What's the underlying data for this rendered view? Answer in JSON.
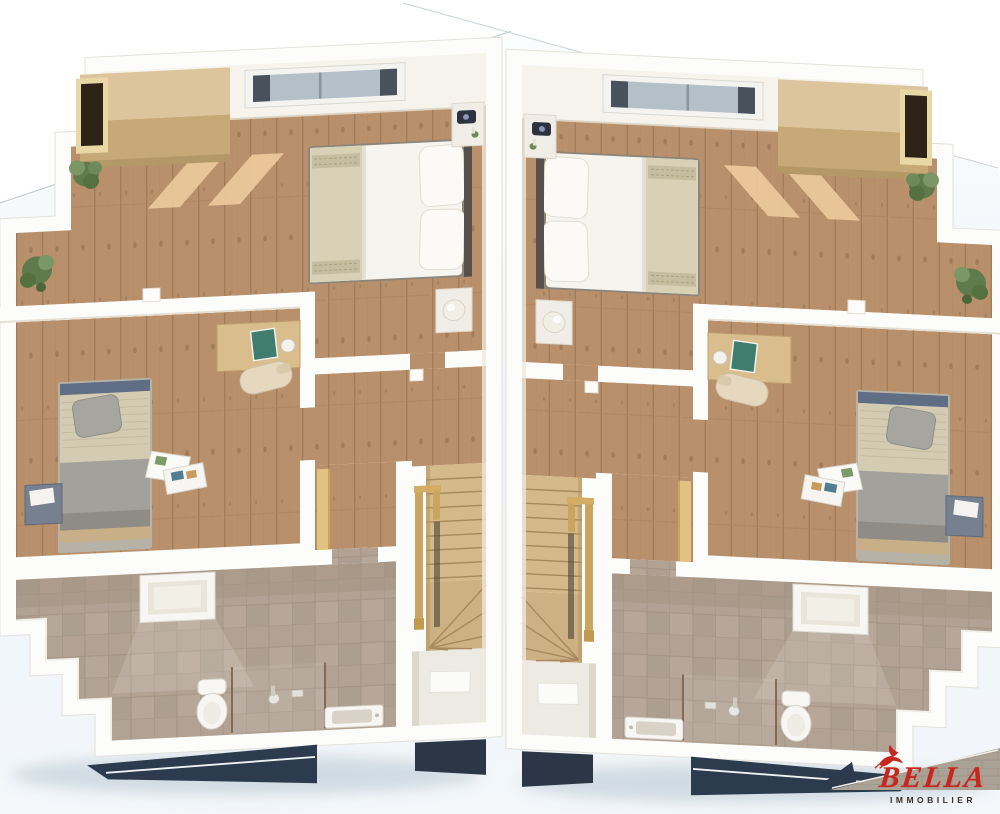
{
  "brand": {
    "name": "BELLA",
    "tagline": "IMMOBILIER",
    "icon": "bird-icon",
    "name_color": "#c5261e",
    "tagline_color": "#3a2f27"
  },
  "scene": {
    "type": "3d-floorplan-top-view",
    "description": "Two mirrored duplex upper floors shown side by side in 3D cutaway",
    "units": [
      {
        "name": "unit-left",
        "rooms": [
          {
            "name": "master-bedroom",
            "floor": "wood",
            "furniture": [
              "roof-window",
              "wardrobe",
              "double-bed",
              "nightstand-with-clock",
              "nightstand-with-lamp",
              "plant",
              "hanging-plant",
              "sunlight-patches"
            ]
          },
          {
            "name": "second-bedroom",
            "floor": "wood",
            "furniture": [
              "single-bed",
              "desk",
              "book",
              "desk-clock",
              "chair",
              "side-box",
              "magazines"
            ]
          },
          {
            "name": "hallway",
            "floor": "wood",
            "furniture": [
              "knee-wall",
              "winder-staircase",
              "handrail",
              "stairwell-landing",
              "doormat"
            ]
          },
          {
            "name": "bathroom",
            "floor": "tile",
            "furniture": [
              "roof-window",
              "toilet",
              "walk-in-shower",
              "washbasin",
              "stepped-knee-wall"
            ]
          }
        ]
      },
      {
        "name": "unit-right",
        "mirror_of": "unit-left",
        "rooms": [
          {
            "name": "master-bedroom"
          },
          {
            "name": "second-bedroom"
          },
          {
            "name": "hallway"
          },
          {
            "name": "bathroom"
          }
        ]
      }
    ]
  },
  "palette": {
    "background_blue": "#eef4f9",
    "wall_white": "#fcfcfa",
    "ceiling": "#f6f3ec",
    "wood_floor": "#b9906c",
    "wood_seam": "#9a7652",
    "sunlight": "#eecb9e",
    "wardrobe_top": "#dcc49c",
    "wardrobe_front": "#c7a877",
    "skylight_glass": "#b4bfc8",
    "bed_linen": "#f6f4ef",
    "bed_runner": "#d8d1b6",
    "single_bed_grey": "#a3a19b",
    "single_bed_beige": "#d3ccb2",
    "stair_wood": "#d5b98b",
    "handrail": "#c9a55e",
    "knee_wall_buff": "#e3c183",
    "landing_pale": "#edeae3",
    "tile_floor": "#b1a293",
    "roof_navy": "#2d3b4f",
    "shadow_blue": "#b6c5d1",
    "plant_green": "#5f7b4c"
  }
}
